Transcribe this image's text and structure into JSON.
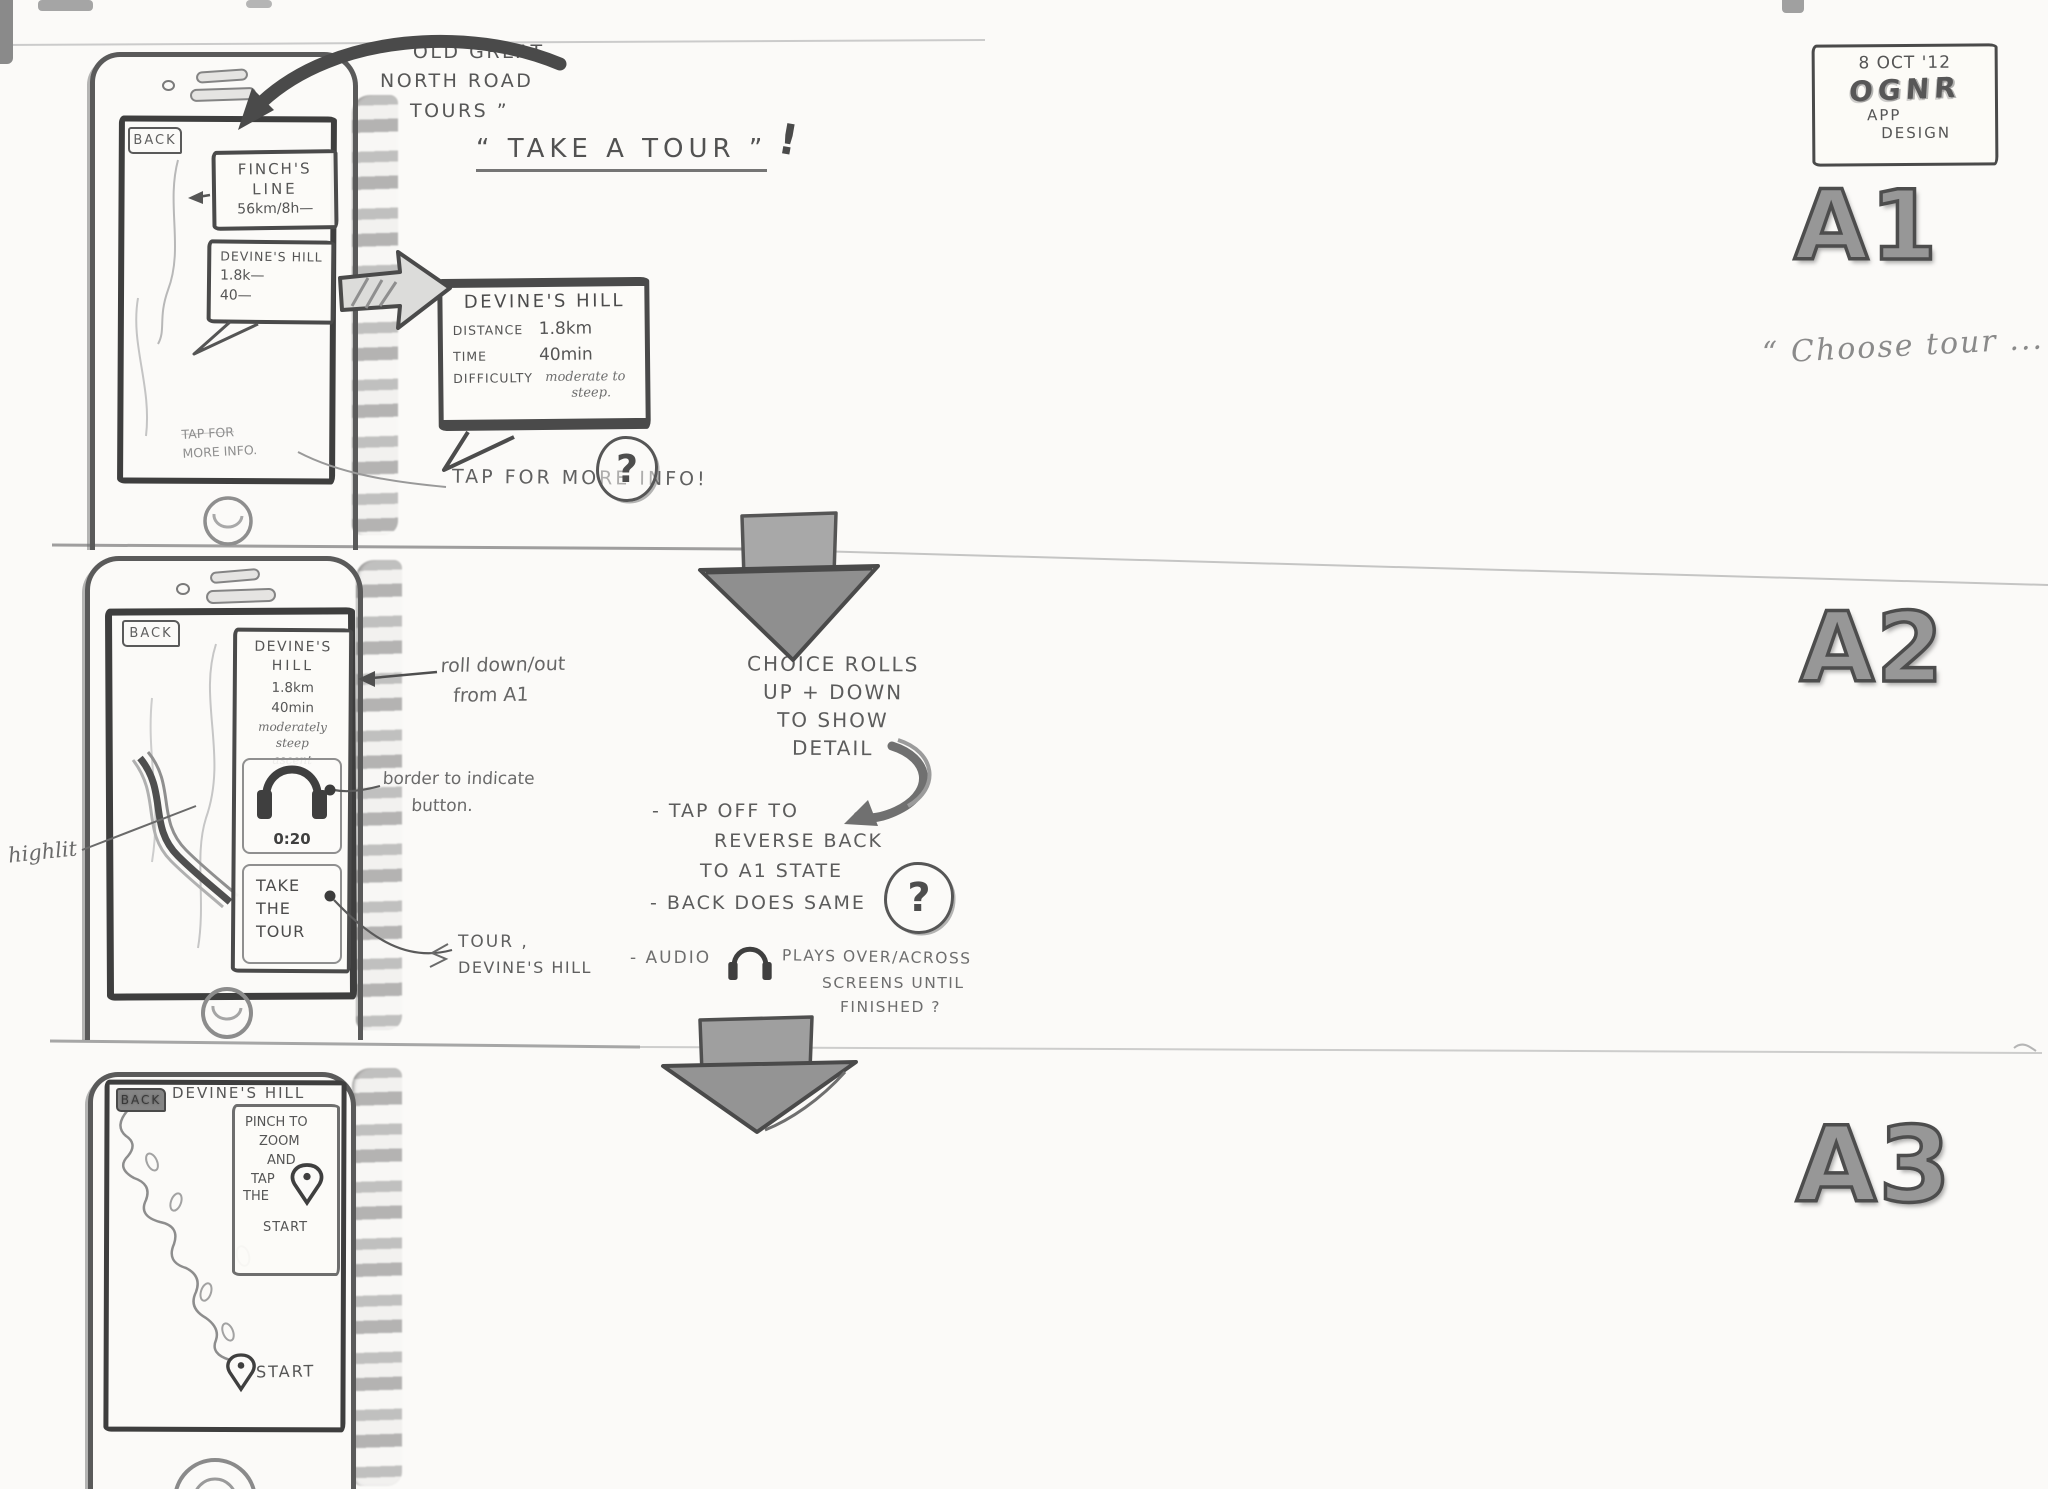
{
  "header": {
    "date": "8 OCT '12",
    "app": "OGNR",
    "l2": "APP",
    "l3": "DESIGN"
  },
  "labels": {
    "a1": "A1",
    "a2": "A2",
    "a3": "A3"
  },
  "captions": {
    "choose": "“ Choose tour ... ”"
  },
  "colors": {
    "paper": "#fbfaf8",
    "pencil": "#5a5a5a",
    "pencil_dark": "#3e3e3e",
    "pencil_light": "#9a9a9a"
  },
  "icons": {
    "headphones": "headphones-icon",
    "map_pin": "map-pin-icon",
    "question": "question-circle-icon"
  },
  "annotations": {
    "app_name": [
      "“ OLD GREAT",
      "NORTH ROAD",
      "TOURS ”"
    ],
    "take_a_tour": "“ TAKE A TOUR ”",
    "bang": "!",
    "tap_big": "TAP FOR MORE INFO!",
    "q": "?",
    "roll": [
      "roll down/out",
      "from A1"
    ],
    "border_btn": [
      "border to indicate",
      "button."
    ],
    "highlit": "highlit",
    "tour_ref": [
      "TOUR ,",
      "DEVINE'S HILL"
    ],
    "choice": [
      "CHOICE ROLLS",
      "UP + DOWN",
      "TO SHOW",
      "DETAIL"
    ],
    "tap_off": [
      "- TAP OFF TO",
      "REVERSE BACK",
      "TO A1 STATE"
    ],
    "back_same": "- BACK DOES SAME",
    "audio_pre": "- AUDIO",
    "audio_post": [
      "PLAYS OVER/ACROSS",
      "SCREENS UNTIL",
      "FINISHED ?"
    ]
  },
  "screen_a1": {
    "back": "BACK",
    "tour1": [
      "FINCH'S",
      "LINE",
      "56km/8h—"
    ],
    "tour2": [
      "DEVINE'S HILL",
      "1.8k—",
      "40—"
    ],
    "tap_hint": [
      "TAP FOR",
      "MORE INFO."
    ]
  },
  "popup": {
    "title": "DEVINE'S HILL",
    "rows": [
      [
        "DISTANCE",
        "1.8km"
      ],
      [
        "TIME",
        "40min"
      ]
    ],
    "difficulty_label": "DIFFICULTY",
    "difficulty": [
      "moderate to",
      "steep."
    ]
  },
  "screen_a2": {
    "back": "BACK",
    "card": [
      "DEVINE'S",
      "HILL",
      "1.8km",
      "40min",
      "moderately",
      "steep",
      "ascent"
    ],
    "time": "0:20",
    "cta": [
      "TAKE",
      "THE",
      "TOUR"
    ]
  },
  "screen_a3": {
    "back": "BACK",
    "title": "DEVINE'S HILL",
    "note": [
      "PINCH TO",
      "ZOOM",
      "AND",
      "TAP",
      "THE",
      "START"
    ],
    "start": "START"
  }
}
